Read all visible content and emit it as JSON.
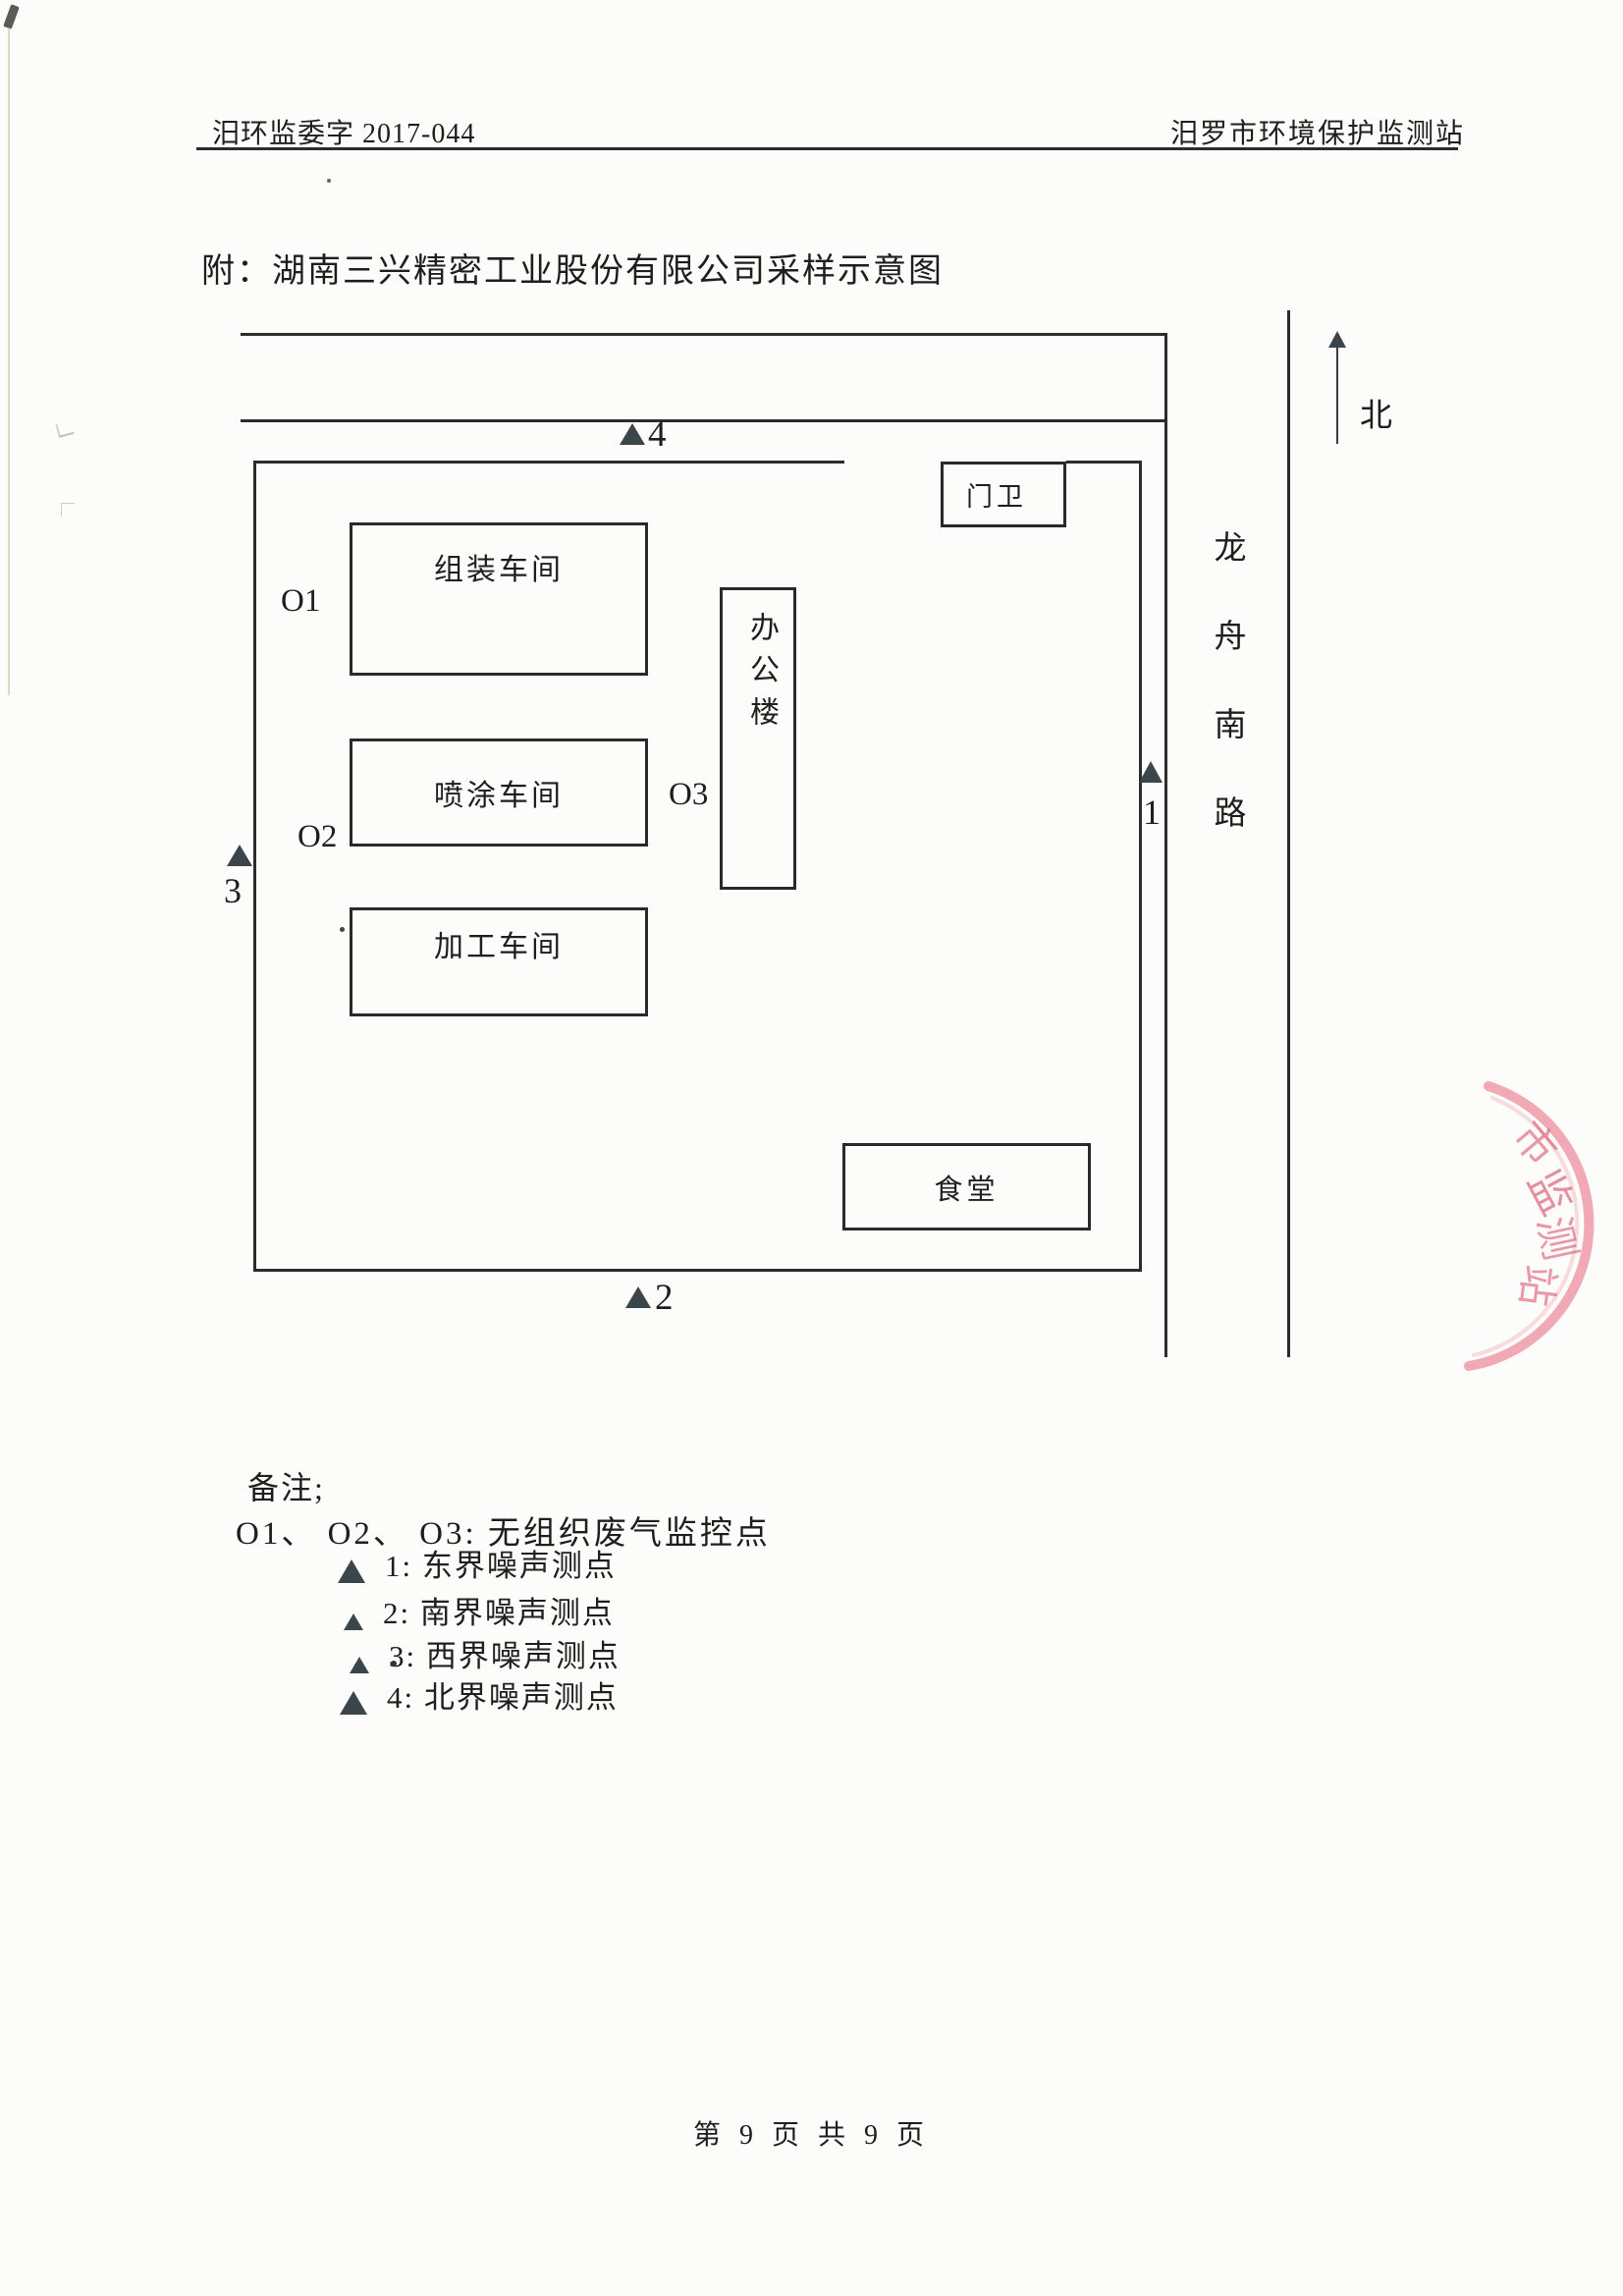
{
  "header": {
    "doc_number": "汨环监委字 2017-044",
    "org_name": "汨罗市环境保护监测站"
  },
  "title": "附：湖南三兴精密工业股份有限公司采样示意图",
  "diagram": {
    "buildings": {
      "assembly": "组装车间",
      "spray": "喷涂车间",
      "machining": "加工车间",
      "office": "办公楼",
      "guard": "门卫",
      "canteen": "食堂"
    },
    "gas_points": {
      "o1": "O1",
      "o2": "O2",
      "o3": "O3"
    },
    "noise_points": {
      "n1": "1",
      "n2": "2",
      "n3": "3",
      "n4": "4"
    },
    "road_name": "龙舟南路",
    "north_label": "北",
    "colors": {
      "line": "#2c2c2c",
      "marker": "#3b464b",
      "stamp": "#e25c78"
    }
  },
  "stamp": {
    "chars": [
      "市",
      "监",
      "测",
      "站"
    ]
  },
  "notes": {
    "heading": "备注;",
    "gas_line": "O1、 O2、 O3: 无组织废气监控点",
    "noise_legend": [
      {
        "text": "1: 东界噪声测点"
      },
      {
        "text": "2: 南界噪声测点"
      },
      {
        "text": "3: 西界噪声测点"
      },
      {
        "text": "4: 北界噪声测点"
      }
    ]
  },
  "footer": "第 9 页 共 9 页"
}
